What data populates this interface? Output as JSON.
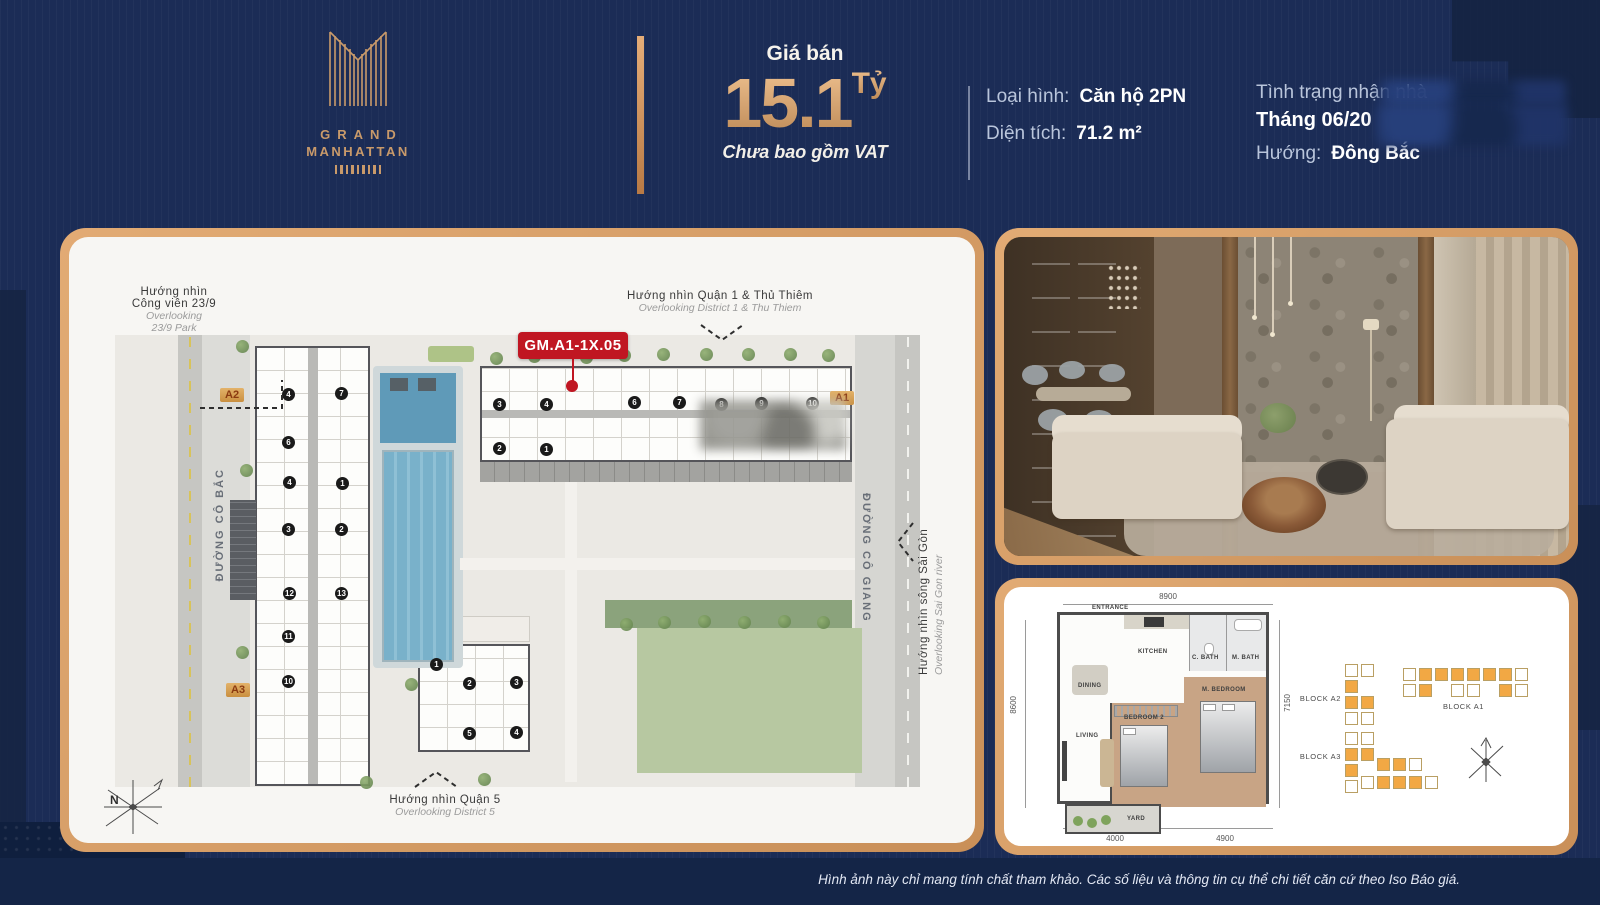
{
  "header": {
    "brand": {
      "name_line1": "GRAND",
      "name_line2": "MANHATTAN"
    },
    "price": {
      "label": "Giá bán",
      "value": "15.1",
      "unit": "Tỷ",
      "vat_note": "Chưa bao gồm VAT"
    },
    "specs": {
      "type_label": "Loại hình:",
      "type_value": "Căn hộ 2PN",
      "area_label": "Diện tích:",
      "area_value": "71.2 m²",
      "handover_label": "Tình trạng nhận nhà",
      "handover_value": "Tháng 06/20",
      "direction_label": "Hướng:",
      "direction_value": "Đông Bắc"
    }
  },
  "site_plan": {
    "unit_badge": "GM.A1-1X.05",
    "direction_labels": {
      "top_vi": "Hướng nhìn Quận 1 & Thủ Thiêm",
      "top_en": "Overlooking District 1 & Thu Thiem",
      "left_vi1": "Hướng nhìn",
      "left_vi2": "Công viên 23/9",
      "left_en1": "Overlooking",
      "left_en2": "23/9 Park",
      "bottom_vi": "Hướng nhìn Quận 5",
      "bottom_en": "Overlooking District 5",
      "right_vi": "Hướng nhìn sông Sài Gòn",
      "right_en": "Overlooking Sai Gon river"
    },
    "streets": {
      "left": "ĐƯỜNG CÔ BẮC",
      "right": "ĐƯỜNG CÔ GIANG"
    },
    "blocks": {
      "a2": "A2",
      "a1": "A1",
      "a3": "A3"
    },
    "compass": "N",
    "unit_numbers": [
      "4",
      "7",
      "6",
      "4",
      "1",
      "3",
      "2",
      "12",
      "13",
      "11",
      "10",
      "1",
      "2",
      "3",
      "5",
      "4",
      "3",
      "4",
      "6",
      "7",
      "8",
      "9",
      "10",
      "2",
      "1"
    ]
  },
  "floor_plan": {
    "room_labels": {
      "entrance": "ENTRANCE",
      "kitchen": "KITCHEN",
      "c_bath": "C. BATH",
      "m_bath": "M. BATH",
      "dining": "DINING",
      "living": "LIVING",
      "bedroom2": "BEDROOM 2",
      "m_bedroom": "M. BEDROOM",
      "yard": "YARD"
    },
    "dimensions": {
      "top": "8900",
      "left": "8600",
      "right": "7150",
      "bottom_left": "4000",
      "bottom_right": "4900"
    },
    "block_labels": {
      "a2": "BLOCK A2",
      "a3": "BLOCK A3",
      "a1": "BLOCK A1"
    }
  },
  "footer": {
    "disclaimer": "Hình ảnh này chỉ mang tính chất tham khảo. Các số liệu và thông tin cụ thể chi tiết căn cứ theo Iso Báo giá."
  }
}
